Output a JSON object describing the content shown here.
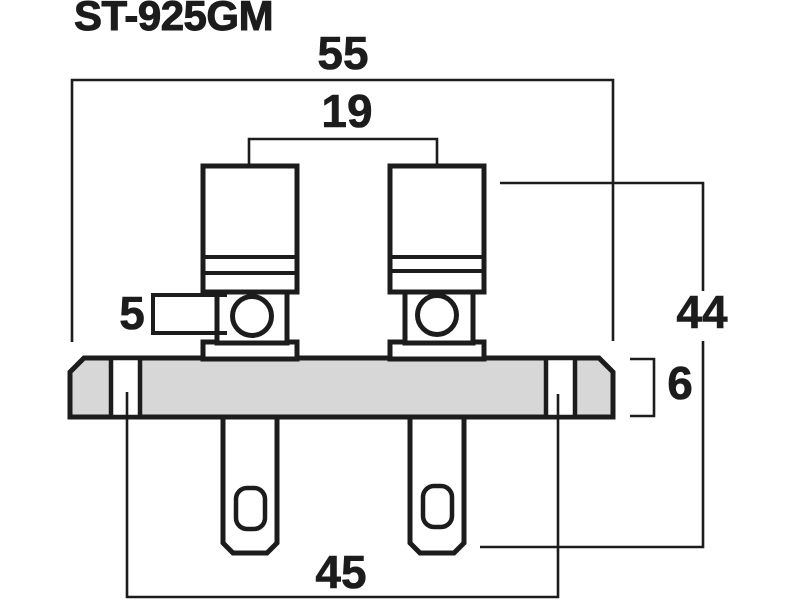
{
  "title": "ST-925GM",
  "dimensions": {
    "width_overall": "55",
    "post_spacing": "19",
    "height_overall": "44",
    "side_tab": "5",
    "plate_thickness": "6",
    "mounting_hole_spacing": "45"
  },
  "colors": {
    "line": "#1c1c1c",
    "plate_fill": "#d7d7d7",
    "background": "#ffffff"
  }
}
